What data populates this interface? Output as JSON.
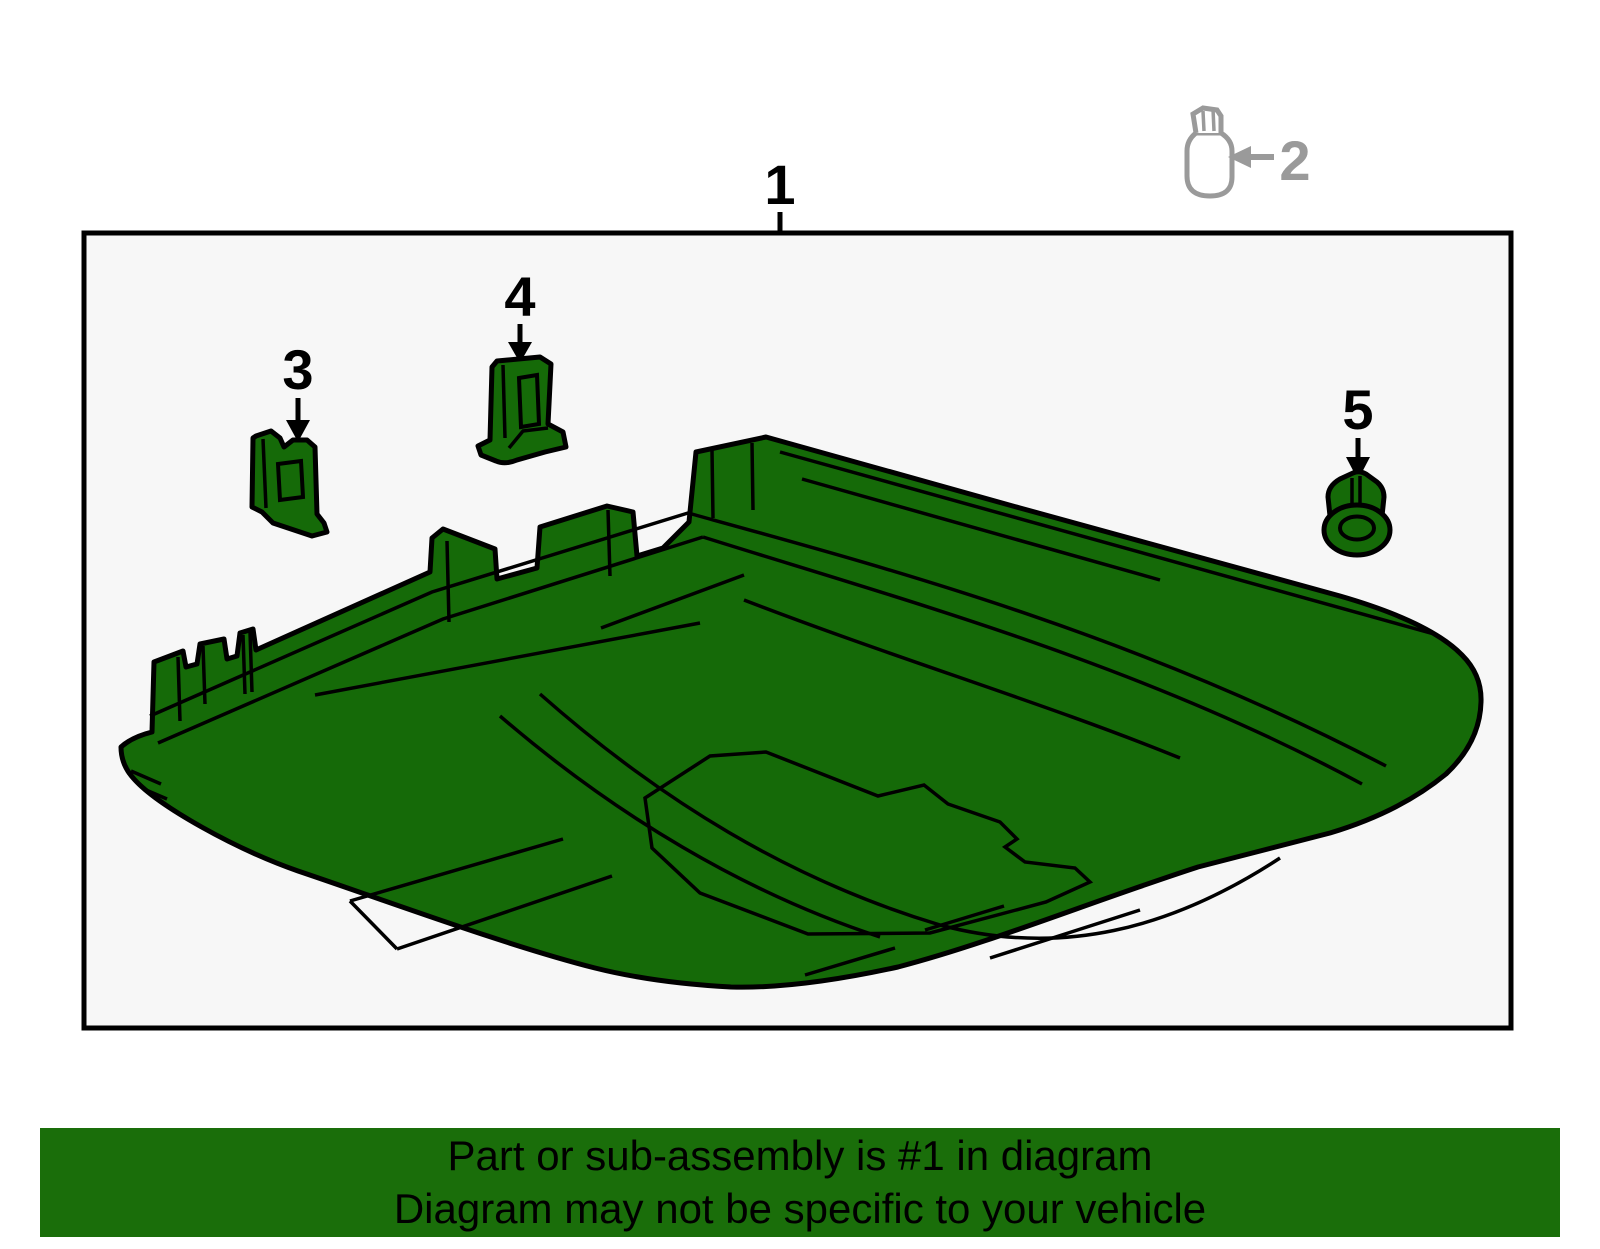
{
  "window": {
    "width": 1600,
    "height": 1249,
    "background": "#ffffff"
  },
  "diagram_box": {
    "background": "#f7f7f7",
    "border_color": "#000000"
  },
  "labels": {
    "part1": "1",
    "part2": "2",
    "part3": "3",
    "part4": "4",
    "part5": "5"
  },
  "icons": {
    "part2_reference": "bulb-icon",
    "callout_arrow": "arrow-down-icon",
    "part2_arrow": "arrow-left-icon"
  },
  "colors": {
    "part_highlight_green": "#156a08",
    "banner_green": "#1a6e0a",
    "reference_gray": "#9a9a9a",
    "outline_black": "#000000",
    "box_background": "#f7f7f7"
  },
  "banner": {
    "line1": "Part or sub-assembly is #1 in diagram",
    "line2": "Diagram may not be specific to your vehicle"
  }
}
